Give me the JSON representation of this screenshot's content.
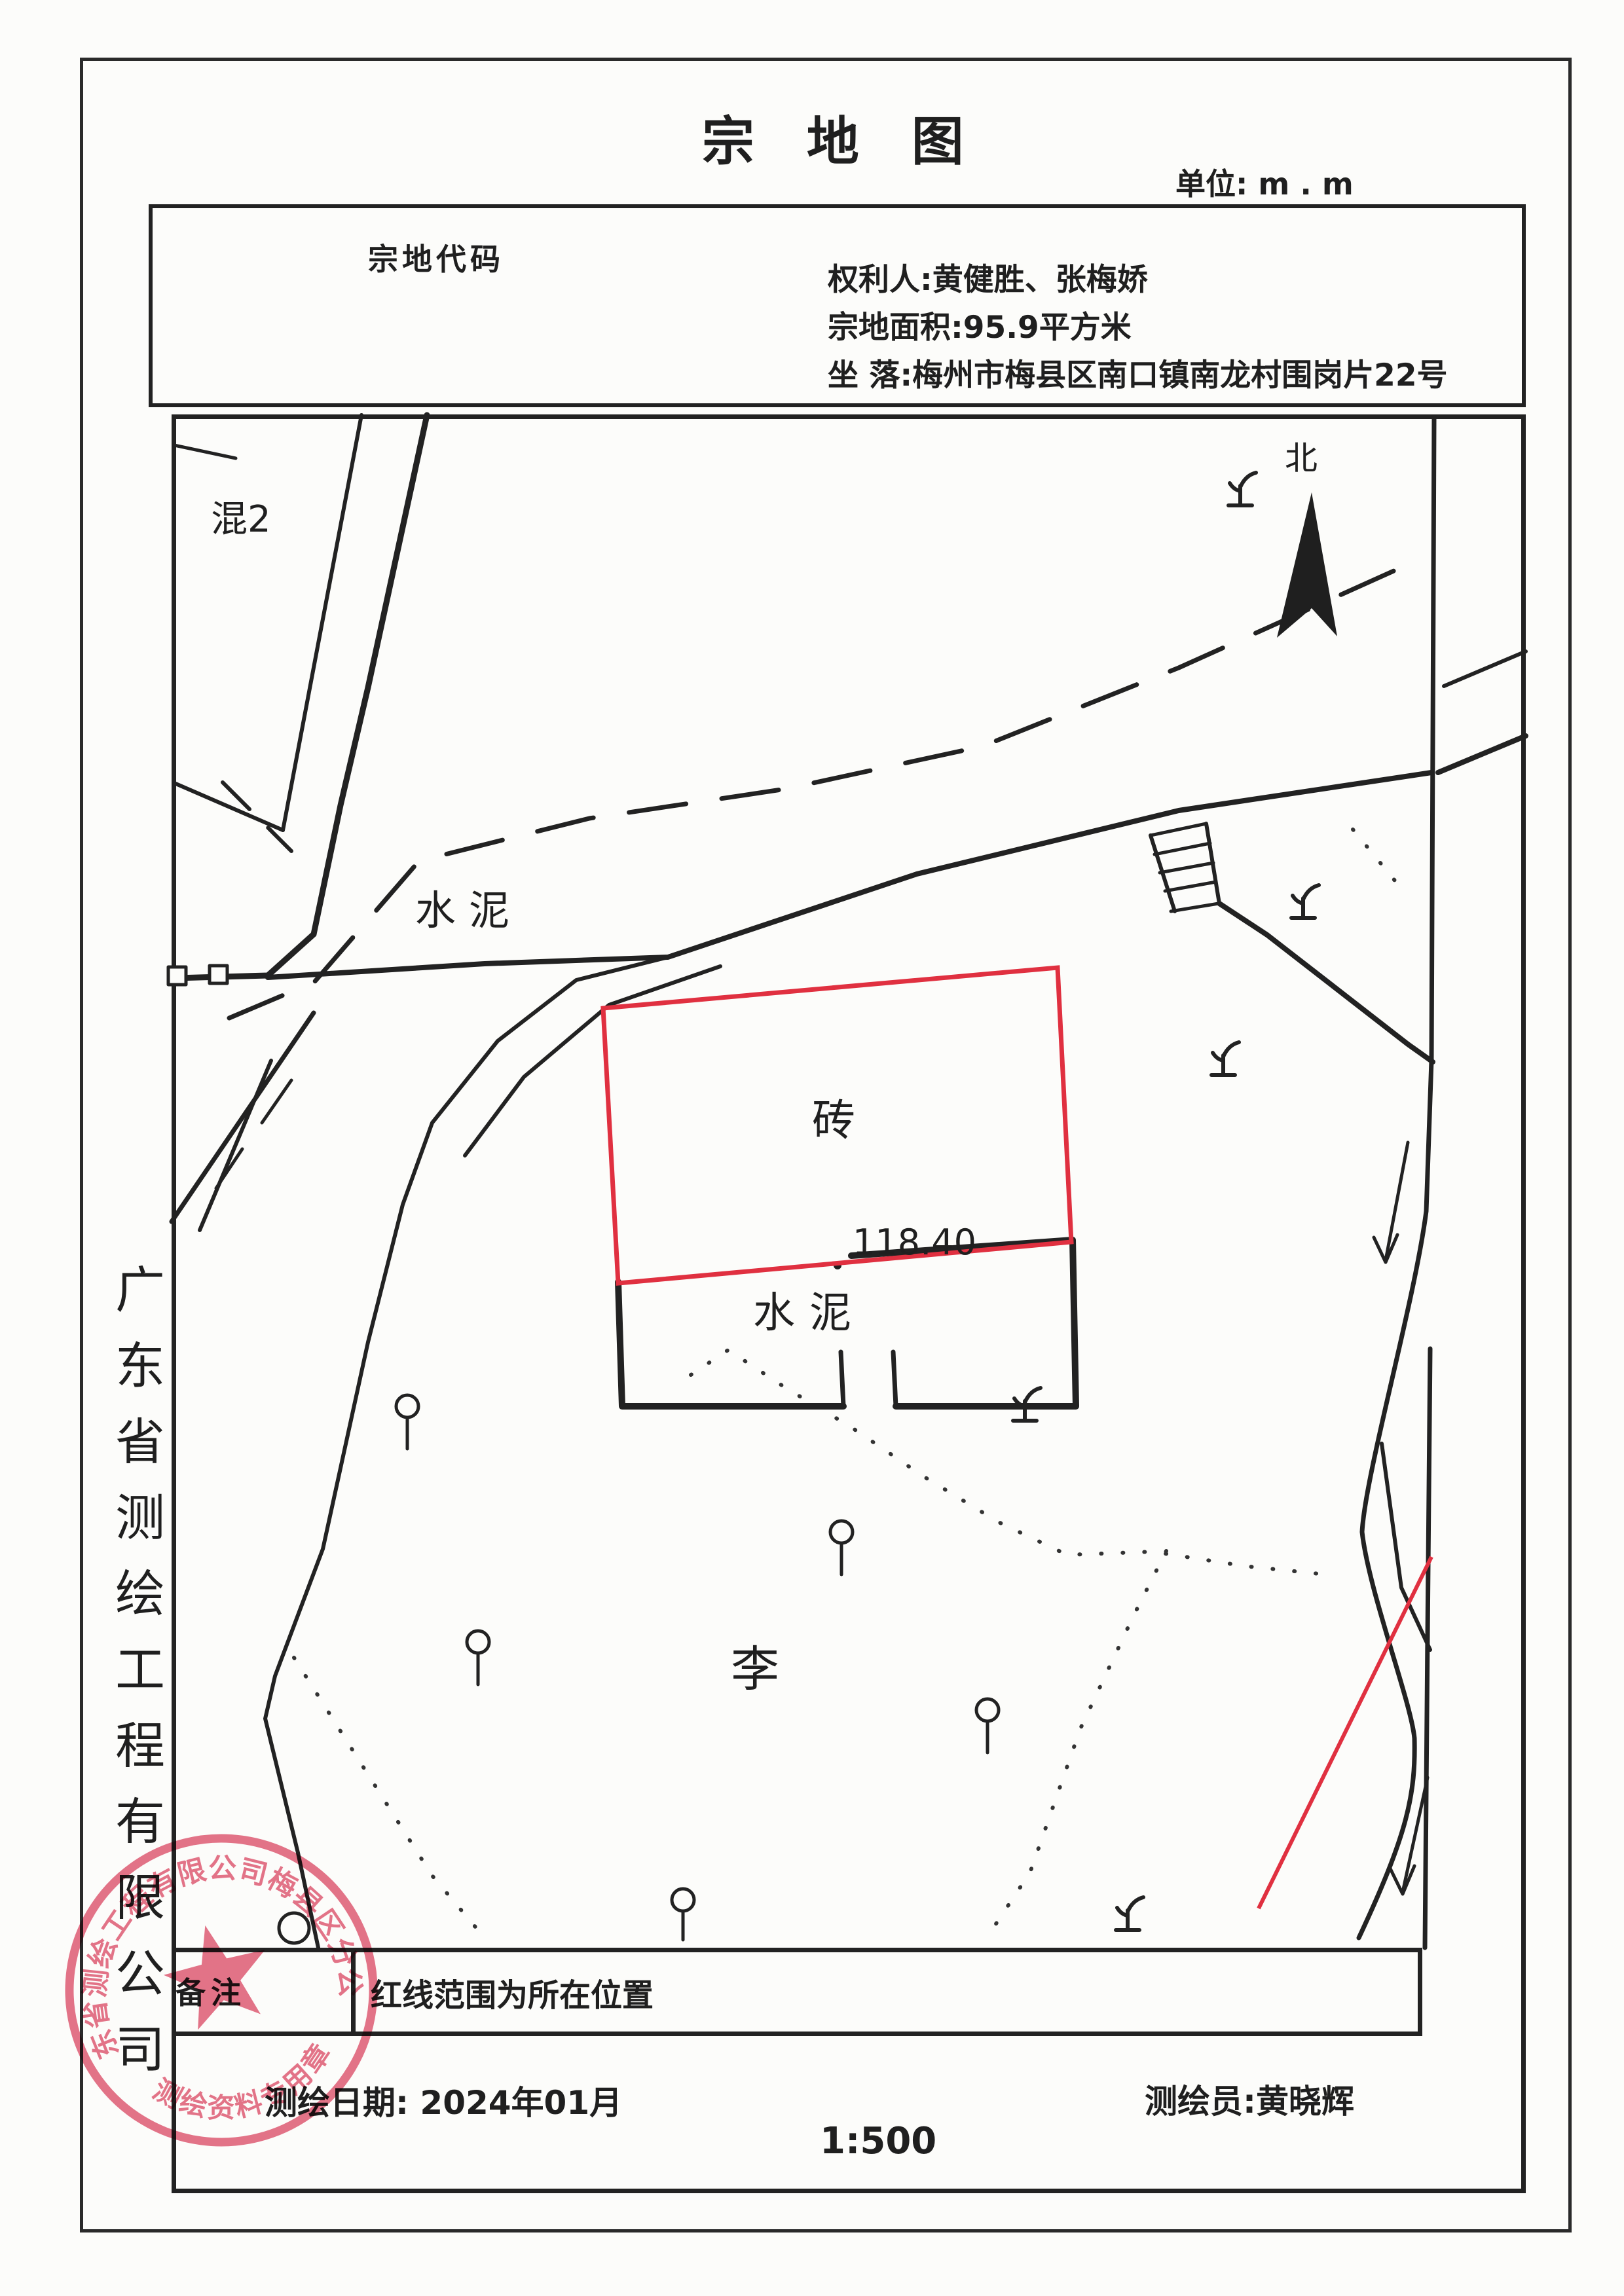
{
  "title": "宗 地 图",
  "unit_label": "单位: m . m",
  "header": {
    "parcel_code_label": "宗地代码",
    "owner": "权利人:黄健胜、张梅娇",
    "area": "宗地面积:95.9平方米",
    "location": "坐 落:梅州市梅县区南口镇南龙村围岗片22号"
  },
  "map_labels": {
    "building_mix2": "混2",
    "cement_road": "水泥",
    "brick": "砖",
    "cement_yard": "水泥",
    "elevation": "118.40",
    "field_owner": "李",
    "north": "北"
  },
  "remarks": {
    "label": "备注",
    "text": "红线范围为所在位置"
  },
  "footer": {
    "survey_date": "测绘日期:  2024年01月",
    "map_scale": "1:500",
    "surveyor": "测绘员:黄晓辉"
  },
  "left_sidebar": {
    "company_vertical": "广东省测绘工程有限公司"
  },
  "seal": {
    "company_arc": "广东省测绘工程有限公司梅县区分公司",
    "bottom_text": "测绘资料专用章"
  },
  "colors": {
    "ink": "#1f1f1f",
    "parcel_red": "#e03040",
    "seal_red": "#e05570"
  }
}
